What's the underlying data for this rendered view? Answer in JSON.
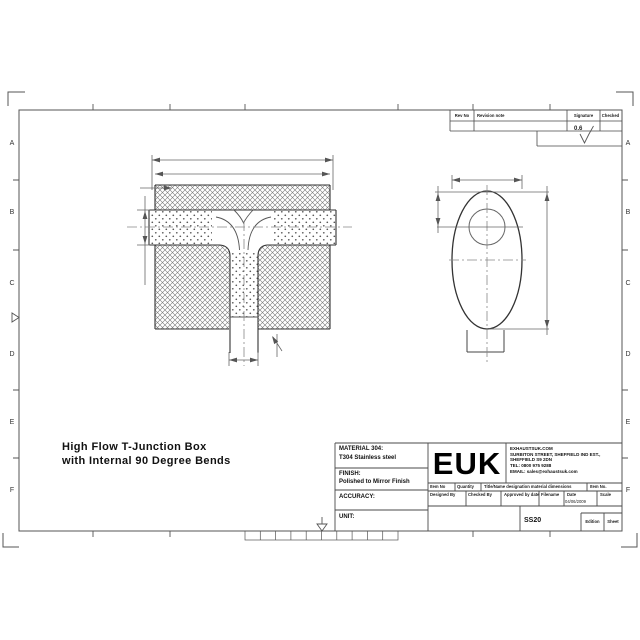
{
  "sheet": {
    "zone_letters": [
      "A",
      "B",
      "C",
      "D",
      "E",
      "F"
    ]
  },
  "revision_table": {
    "col_rev_no": "Rev No",
    "col_revision_note": "Revision note",
    "col_signature": "Signature",
    "col_checked": "Checked",
    "surface_finish_value": "0.6"
  },
  "drawing_title": {
    "line1": "High Flow T-Junction Box",
    "line2": "with Internal 90 Degree Bends"
  },
  "title_block": {
    "material_label": "MATERIAL 304:",
    "material_value": "T304 Stainless steel",
    "finish_label": "FINISH:",
    "finish_value": "Polished to Mirror Finish",
    "accuracy_label": "ACCURACY:",
    "unit_label": "UNIT:",
    "logo_text": "EUK",
    "company_web": "EXHAUSTSUK.COM",
    "company_street": "SURBITON STREET, SHEFFIELD IND EST.,",
    "company_city": "SHEFFIELD S9 2DN",
    "company_tel": "TEL: 0800 975 9288",
    "company_email": "EMAIL: sales@exhaustsuk.com",
    "item_no_label": "Item No",
    "quantity_label": "Quantity",
    "designation_label": "Title/Name designation material dimensions",
    "item_no2_label": "Item No.",
    "designed_by_label": "Designed By",
    "checked_by_label": "Checked By",
    "approved_label": "Approved by date",
    "filename_label": "Filename",
    "date_label": "Date",
    "scale_label": "Scale",
    "date_value": "04/06/2009",
    "drawing_number": "SS20",
    "edition_label": "Edition",
    "sheet_label": "Sheet"
  }
}
